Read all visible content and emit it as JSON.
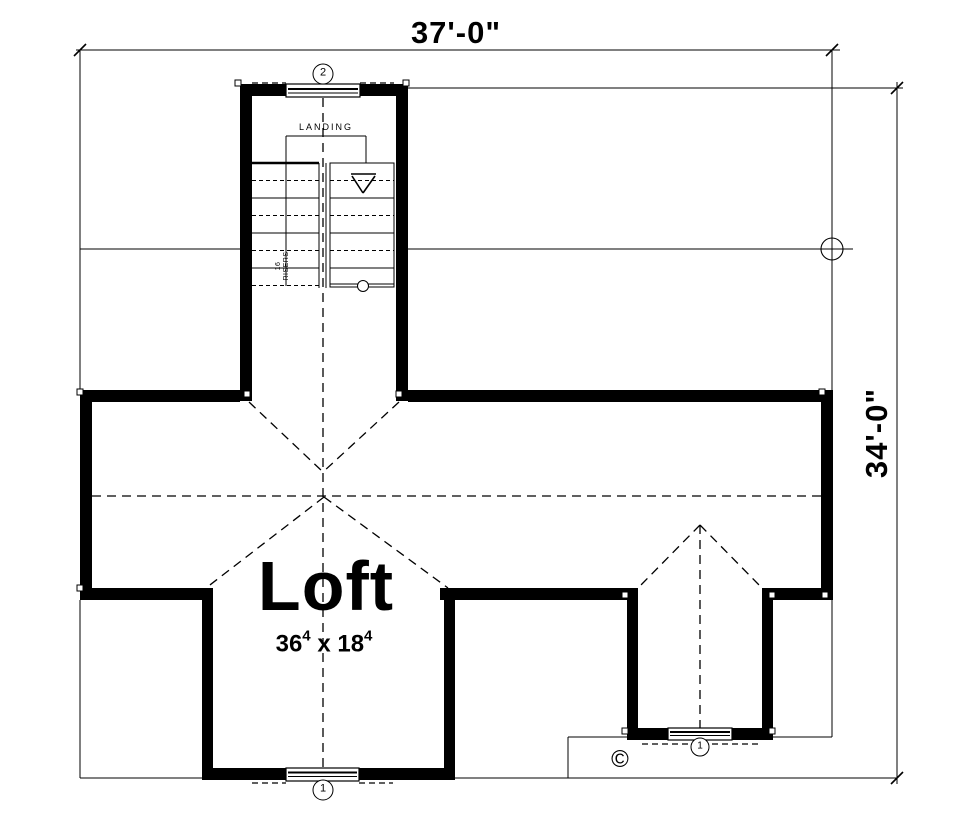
{
  "colors": {
    "ink": "#000000",
    "paper": "#ffffff"
  },
  "dimensions": {
    "top": "37'-0\"",
    "right": "34'-0\""
  },
  "room": {
    "name": "Loft",
    "size": {
      "w": "36",
      "w_sup": "4",
      "sep": "x",
      "h": "18",
      "h_sup": "4"
    }
  },
  "stairs": {
    "landing_label": "LANDING",
    "note_line1": "16",
    "note_line2": "RISERS"
  },
  "tags": {
    "top_window": "2",
    "bottom_window": "1",
    "dormer_window": "1"
  },
  "copyright_symbol": "©"
}
